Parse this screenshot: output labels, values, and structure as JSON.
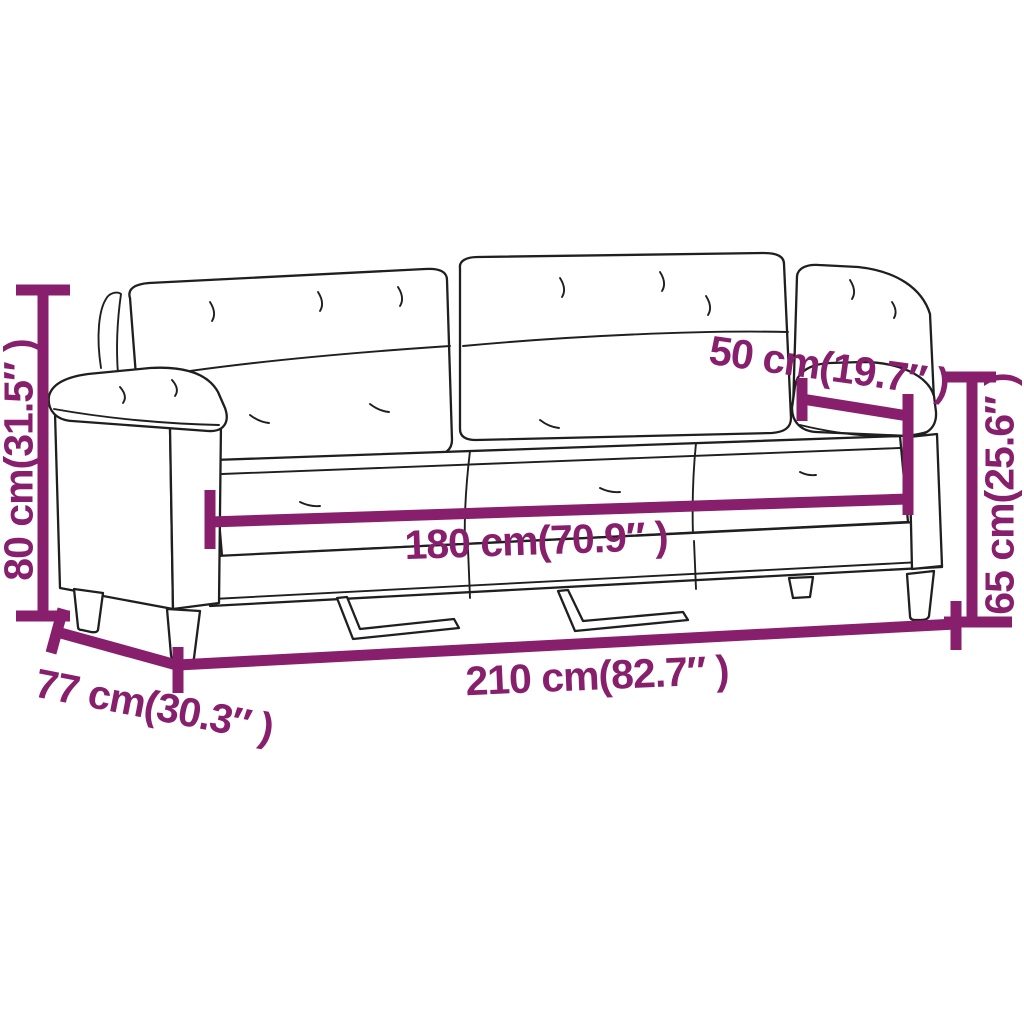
{
  "diagram": {
    "subject": "three-seater sofa dimension drawing",
    "accent_color": "#871F6D",
    "outline_color": "#1f1f1f",
    "background_color": "#ffffff",
    "dimensions": {
      "height": {
        "value": "80",
        "unit": "cm",
        "inches": "31.5",
        "label": "80 cm(31.5″ )"
      },
      "seat_depth": {
        "value": "50",
        "unit": "cm",
        "inches": "19.7",
        "label": "50 cm(19.7″ )"
      },
      "seat_height": {
        "value": "65",
        "unit": "cm",
        "inches": "25.6",
        "label": "65 cm(25.6″ )"
      },
      "seat_width": {
        "value": "180",
        "unit": "cm",
        "inches": "70.9",
        "label": "180 cm(70.9″ )"
      },
      "total_width": {
        "value": "210",
        "unit": "cm",
        "inches": "82.7",
        "label": "210 cm(82.7″ )"
      },
      "total_depth": {
        "value": "77",
        "unit": "cm",
        "inches": "30.3",
        "label": "77 cm(30.3″ )"
      }
    }
  }
}
